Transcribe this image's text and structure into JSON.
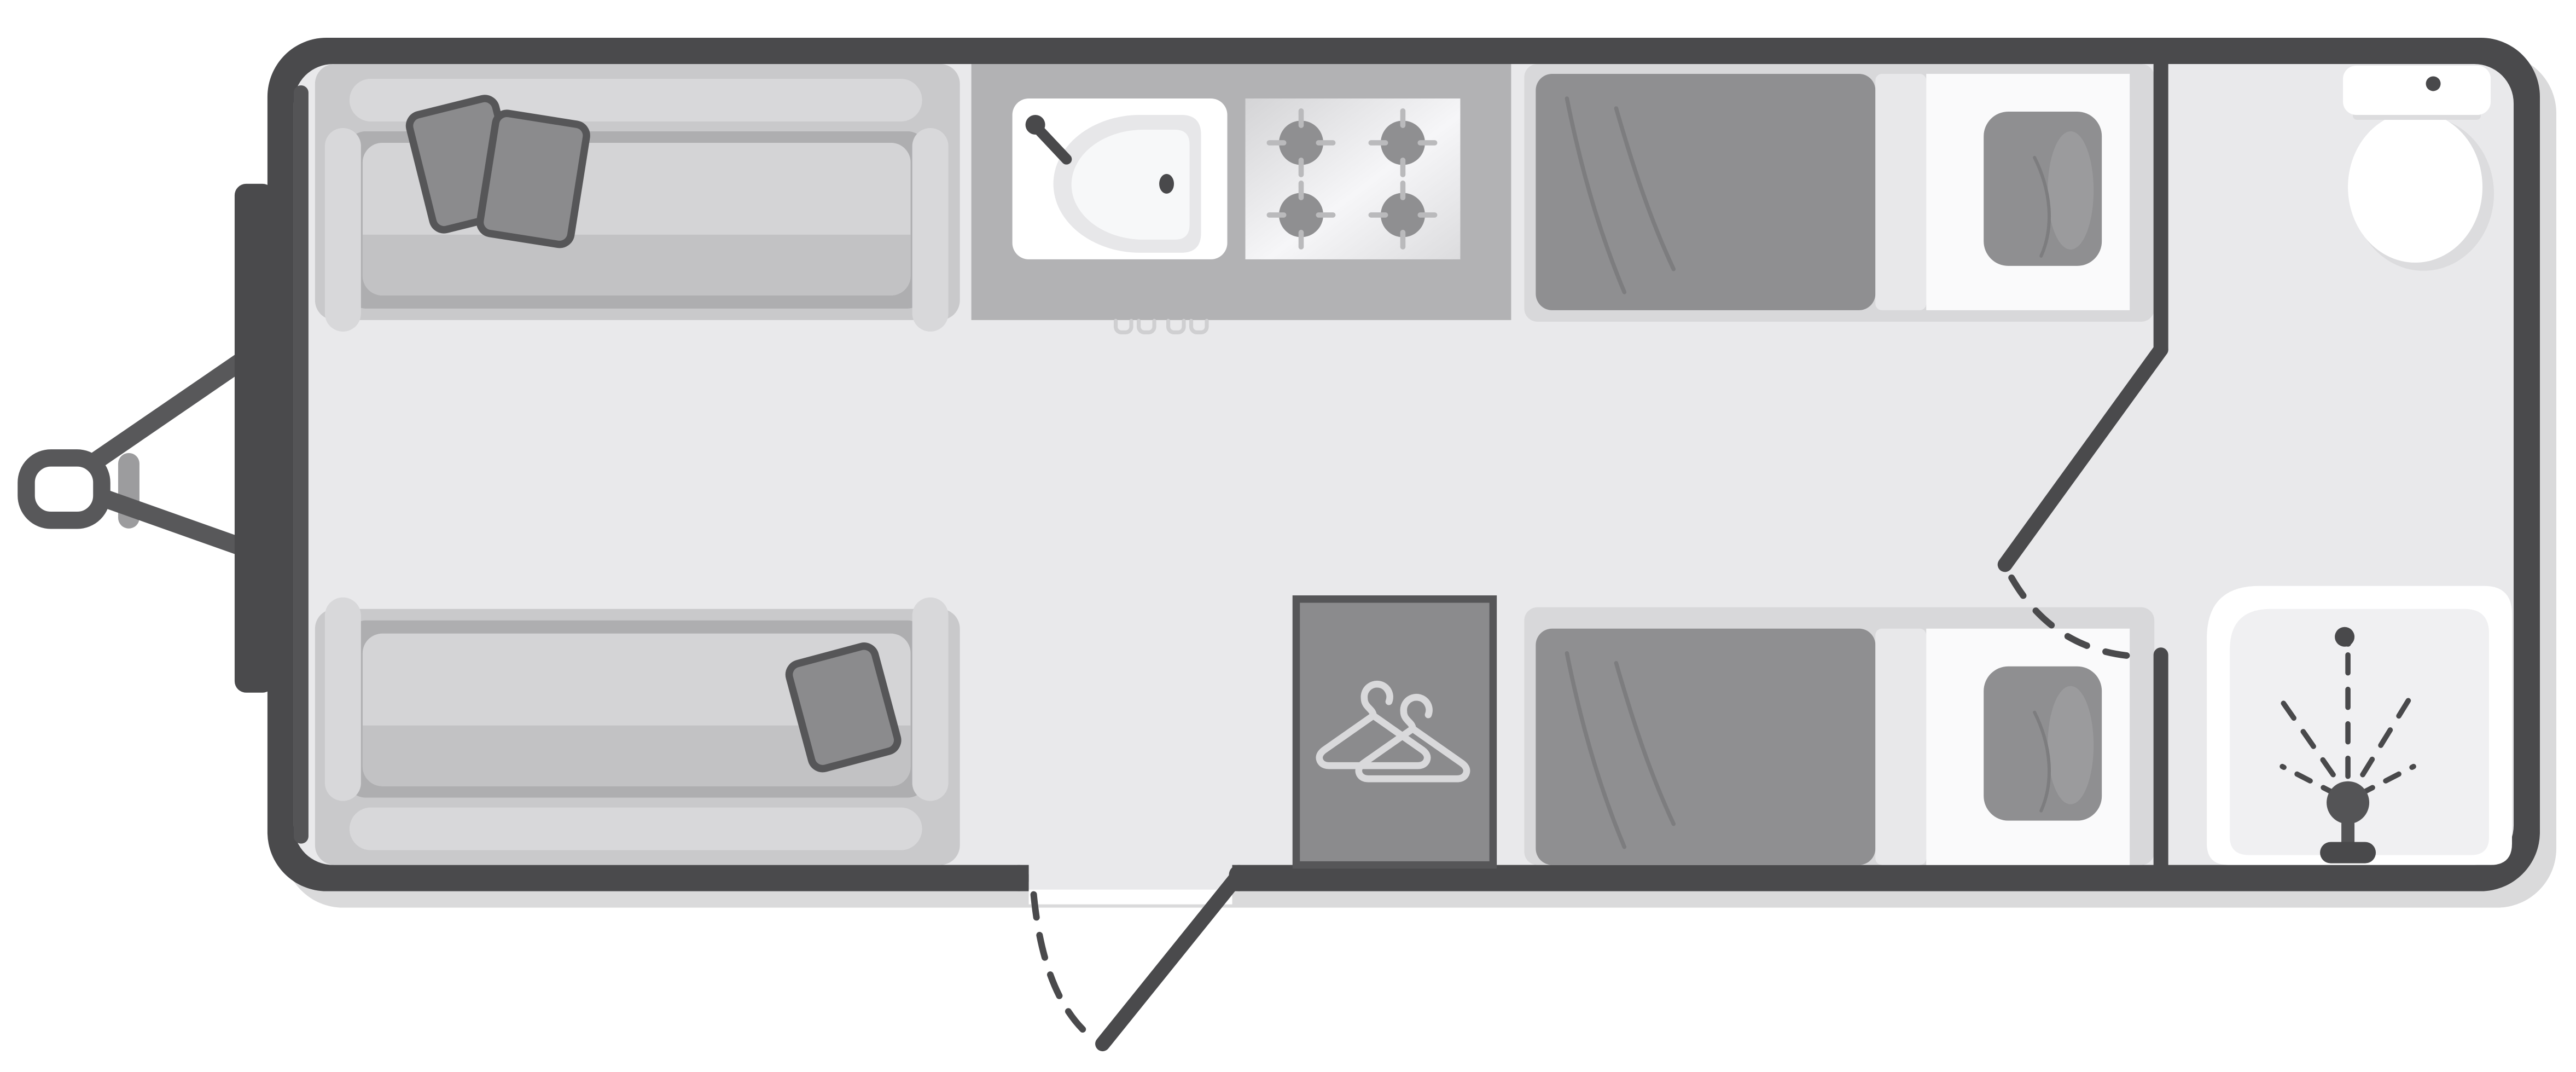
{
  "diagram": {
    "type": "caravan-floorplan-top-view",
    "orientation": "hitch-on-left",
    "rooms": [
      "front-lounge",
      "kitchen",
      "twin-bedroom",
      "end-bathroom"
    ],
    "items": [
      "tow-hitch",
      "front-bumper",
      "front-sofa-top",
      "front-sofa-bottom",
      "scatter-cushions",
      "kitchen-counter",
      "sink-with-tap",
      "hob-4-burner",
      "cabinet-handles",
      "entry-door-open-with-swing-arc",
      "wardrobe-with-hangers",
      "single-bed-top",
      "single-bed-bottom",
      "bed-pillows",
      "bathroom-partition-door-with-swing-arc",
      "toilet",
      "shower-tray-with-shower-head-spray"
    ]
  },
  "palette": {
    "wall": "#4a4a4c",
    "wallAccent": "#545456",
    "hitch": "#58585a",
    "jockey": "#9c9c9e",
    "floor": "#e9e9eb",
    "shadow": "#dadadb",
    "counter": "#b2b2b4",
    "sofaBase": "#c9c9cb",
    "sofaTrim": "#d8d8da",
    "sofaWell": "#aeaeb0",
    "cushion": "#d4d4d6",
    "cushionShade": "#c2c2c4",
    "softFabric": "#8f8f91",
    "softFabricDark": "#8b8b8d",
    "pillowOutline": "#565658",
    "pillowHighlight": "#9b9b9d",
    "wrinkle": "#7d7d7f",
    "bedFrame": "#d8d8da",
    "sheet": "#fafafb",
    "fold": "#e8e8ea",
    "white": "#ffffff",
    "trayInner": "#f0f0f2",
    "fixtureShadow": "#dcdcde",
    "dark": "#49494b",
    "burnerTick": "#bababc",
    "basinOuter": "#e7e7e9",
    "basinInner": "#f7f8f9",
    "hanger": "#d9d9db",
    "handle": "#cfcfd1",
    "stoveLight": "#f6f6f8",
    "stoveDark": "#d4d4d6"
  }
}
